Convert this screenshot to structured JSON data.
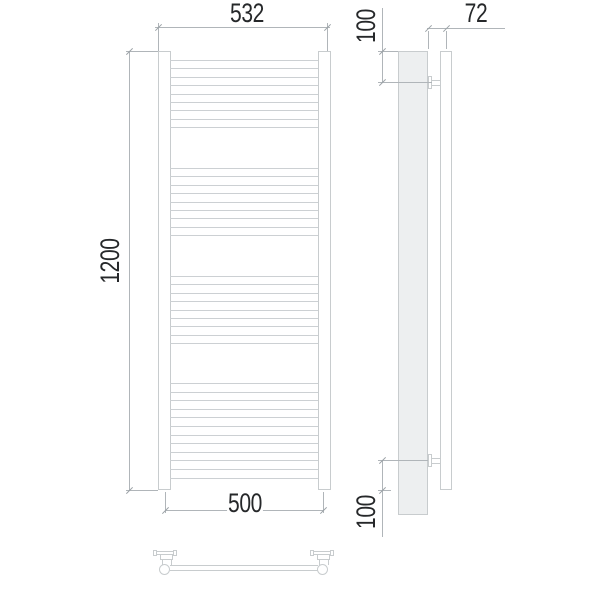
{
  "dimensions": {
    "overall_width": "532",
    "height": "1200",
    "axis_width": "500",
    "depth": "72",
    "top_bracket_offset": "100",
    "bottom_bracket_offset": "100"
  },
  "front_view": {
    "rung_groups": [
      {
        "start": 60,
        "pitch": 8.4,
        "count": 9
      },
      {
        "start": 168,
        "pitch": 8.4,
        "count": 9
      },
      {
        "start": 276,
        "pitch": 8.4,
        "count": 9
      },
      {
        "start": 383,
        "pitch": 8.6,
        "count": 12
      }
    ]
  },
  "colors": {
    "line": "#c8ccce",
    "rung": "#ccd0d3",
    "dim_line": "#b0b5b9",
    "tick": "#9ba1a6",
    "fill": "#edeff0",
    "text": "#26282a",
    "bg": "#ffffff"
  }
}
